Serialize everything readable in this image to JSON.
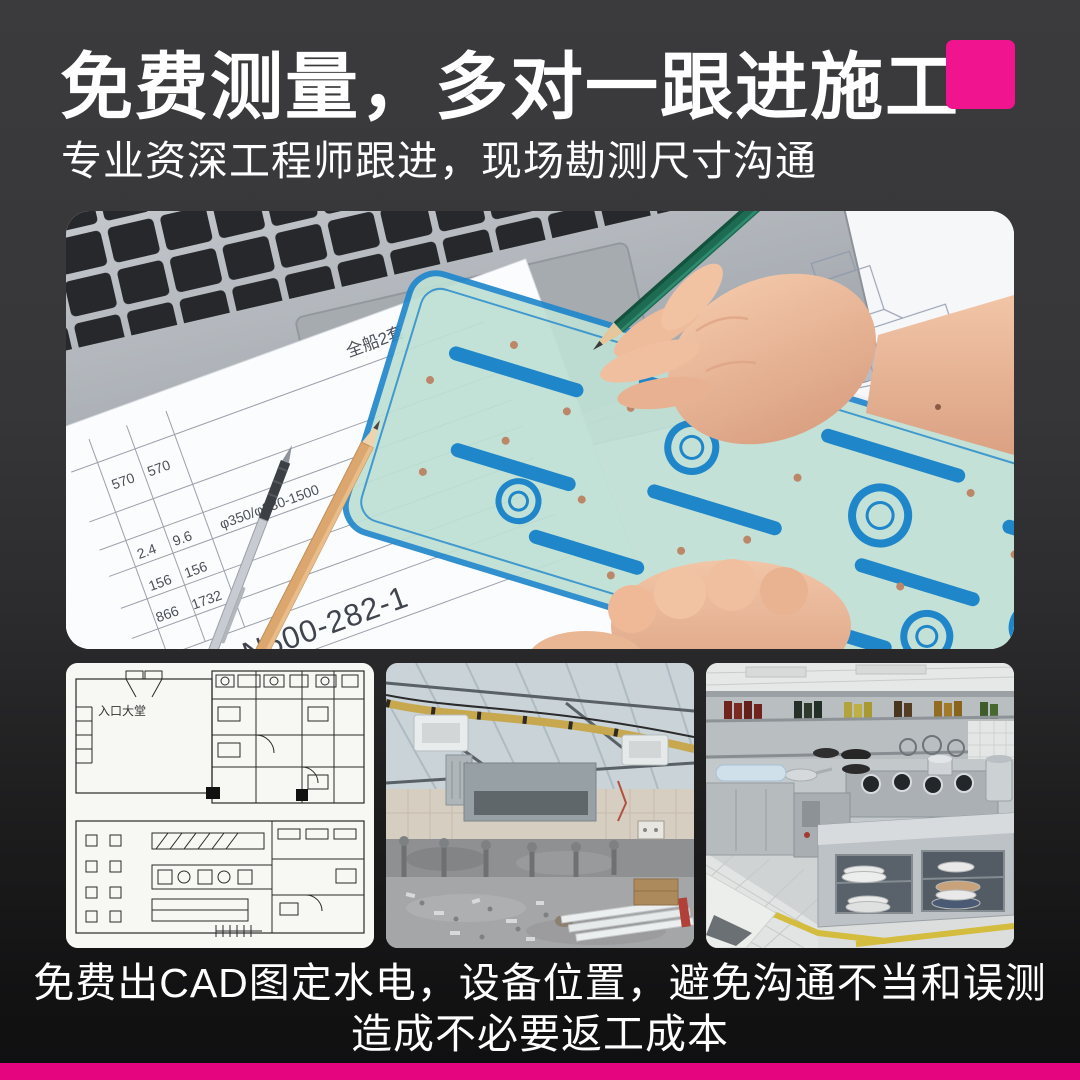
{
  "theme": {
    "accent_square": "#F0148E",
    "footer_bar": "#E5067F",
    "bg_top": "#3B3B3D",
    "bg_bottom": "#121213",
    "text_color": "#FFFFFF"
  },
  "header": {
    "title": "免费测量，多对一跟进施工",
    "subtitle": "专业资深工程师跟进，现场勘测尺寸沟通"
  },
  "hero_photo": {
    "alt": "工程师双手持绿色铅笔在图纸上绘图，旁有笔记本电脑、铅笔与蓝色模板尺",
    "blueprint_texts": {
      "sheet_note": "全船2套",
      "spec": "φ350/φ330-1500",
      "doc_code": "DLN600-282-1",
      "side_label": "系统",
      "bottom_note": "6000M3把",
      "table": [
        [
          "570",
          "570"
        ],
        [
          "2.4",
          "9.6"
        ],
        [
          "156",
          "156"
        ],
        [
          "866",
          "1732"
        ]
      ]
    }
  },
  "gallery": {
    "items": [
      {
        "name": "cad-floorplan",
        "label": "入口大堂"
      },
      {
        "name": "construction-site",
        "label": ""
      },
      {
        "name": "finished-kitchen",
        "label": ""
      }
    ]
  },
  "caption": {
    "line1": "免费出CAD图定水电，设备位置，避免沟通不当和误测",
    "line2": "造成不必要返工成本"
  }
}
